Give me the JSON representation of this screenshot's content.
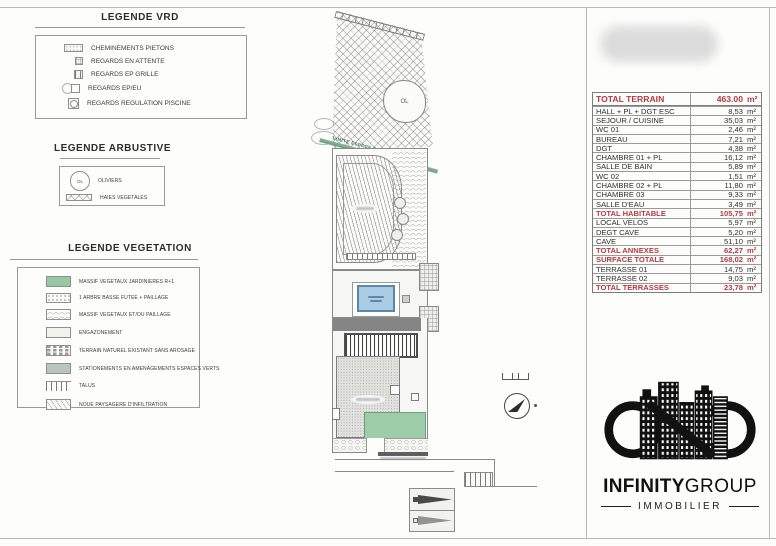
{
  "legend_vrd": {
    "title": "LEGENDE VRD",
    "items": [
      {
        "label": "CHEMINEMENTS PIETONS"
      },
      {
        "label": "REGARDS  EN ATTENTE"
      },
      {
        "label": "REGARDS  EP GRILLE"
      },
      {
        "label": "REGARDS  EP/EU"
      },
      {
        "label": "REGARDS  REGULATION PISCINE"
      }
    ]
  },
  "legend_arbustive": {
    "title": "LEGENDE ARBUSTIVE",
    "icon_text": "OL",
    "items": [
      {
        "label": "OLIVIERS"
      },
      {
        "label": "HAIES VEGETALES"
      }
    ]
  },
  "legend_vegetation": {
    "title": "LEGENDE VEGETATION",
    "items": [
      {
        "label": "MASSIF VEGETAUX JARDINIERES R+1"
      },
      {
        "label": "1 ARBRE BASSE FUTEE + PAILLAGE"
      },
      {
        "label": "MASSIF VEGETAUX ET/OU PAILLAGE"
      },
      {
        "label": "ENGAZONEMENT"
      },
      {
        "label": "TERRAIN NATUREL EXISTANT SANS AROSAGE"
      },
      {
        "label": "STATIONEMENTS EN AMENAGEMENTS ESPACES VERTS"
      },
      {
        "label": "TALUS"
      },
      {
        "label": "NOUE PAYSAGERE D'INFILTRATION"
      }
    ]
  },
  "plan": {
    "labels": {
      "limite": "LIMITE ESPACE BOISE CLASSE",
      "olivier": "OL"
    }
  },
  "table": {
    "header": {
      "label": "TOTAL TERRAIN",
      "value": "463.00",
      "unit": "m²"
    },
    "rows": [
      {
        "label": "HALL + PL + DGT ESC",
        "value": "8,53",
        "unit": "m²",
        "total": false
      },
      {
        "label": "SEJOUR / CUISINE",
        "value": "35,03",
        "unit": "m²",
        "total": false
      },
      {
        "label": "WC 01",
        "value": "2,46",
        "unit": "m²",
        "total": false
      },
      {
        "label": "BUREAU",
        "value": "7,21",
        "unit": "m²",
        "total": false
      },
      {
        "label": "DGT",
        "value": "4,38",
        "unit": "m²",
        "total": false
      },
      {
        "label": "CHAMBRE 01 + PL",
        "value": "16,12",
        "unit": "m²",
        "total": false
      },
      {
        "label": "SALLE DE BAIN",
        "value": "5,89",
        "unit": "m²",
        "total": false
      },
      {
        "label": "WC 02",
        "value": "1,51",
        "unit": "m²",
        "total": false
      },
      {
        "label": "CHAMBRE 02 + PL",
        "value": "11,80",
        "unit": "m²",
        "total": false
      },
      {
        "label": "CHAMBRE 03",
        "value": "9,33",
        "unit": "m²",
        "total": false
      },
      {
        "label": "SALLE D'EAU",
        "value": "3,49",
        "unit": "m²",
        "total": false
      },
      {
        "label": "TOTAL HABITABLE",
        "value": "105,75",
        "unit": "m²",
        "total": true
      },
      {
        "label": "LOCAL VELOS",
        "value": "5,97",
        "unit": "m²",
        "total": false
      },
      {
        "label": "DEGT CAVE",
        "value": "5,20",
        "unit": "m²",
        "total": false
      },
      {
        "label": "CAVE",
        "value": "51,10",
        "unit": "m²",
        "total": false
      },
      {
        "label": "TOTAL ANNEXES",
        "value": "62,27",
        "unit": "m²",
        "total": true
      },
      {
        "label": "SURFACE TOTALE",
        "value": "168,02",
        "unit": "m²",
        "total": true
      },
      {
        "label": "TERRASSE 01",
        "value": "14,75",
        "unit": "m²",
        "total": false
      },
      {
        "label": "TERRASSE 02",
        "value": "9,03",
        "unit": "m²",
        "total": false
      },
      {
        "label": "TOTAL TERRASSES",
        "value": "23,78",
        "unit": "m²",
        "total": true
      }
    ]
  },
  "logo": {
    "brand_bold": "INFINITY",
    "brand_light": "GROUP",
    "subtitle": "IMMOBILIER"
  },
  "colors": {
    "table_accent_red": "#b23b40",
    "vegetation_green": "#97c8a2",
    "parking_gray_green": "#b9c6bf",
    "pool_blue": "#a9cde5",
    "pool_border": "#5e86ac",
    "boise_band_teal": "#7fa893",
    "plan_planter_green": "#9ccda8",
    "dark_band_gray": "#858585"
  }
}
